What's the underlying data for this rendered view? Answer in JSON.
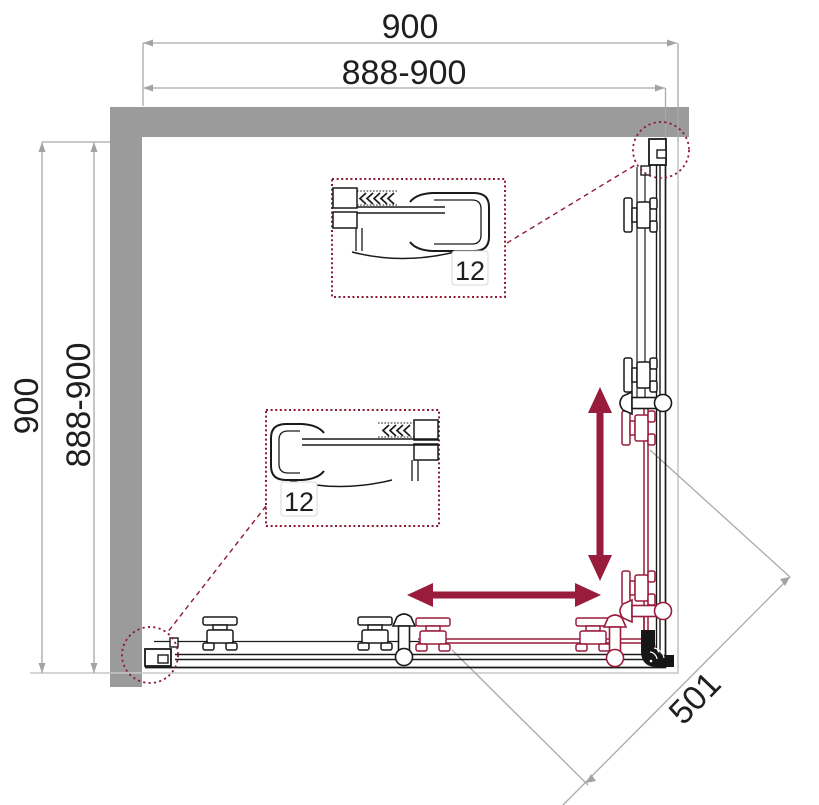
{
  "diagram": {
    "kind": "shower-enclosure-plan-drawing",
    "dimensions": {
      "top_overall": "900",
      "top_adjustable": "888-900",
      "left_overall": "900",
      "left_adjustable": "888-900",
      "diagonal_entry": "501"
    },
    "details": {
      "top_callout": {
        "thickness": "12"
      },
      "bottom_callout": {
        "thickness": "12"
      }
    },
    "colors": {
      "wall_gray": "#9b9b9b",
      "dimension_gray": "#a9a9a9",
      "tray_gray": "#c7c7c7",
      "line_black": "#1a1a1a",
      "accent_maroon": "#9a1c3c",
      "callout_maroon": "#8e1b33"
    }
  }
}
